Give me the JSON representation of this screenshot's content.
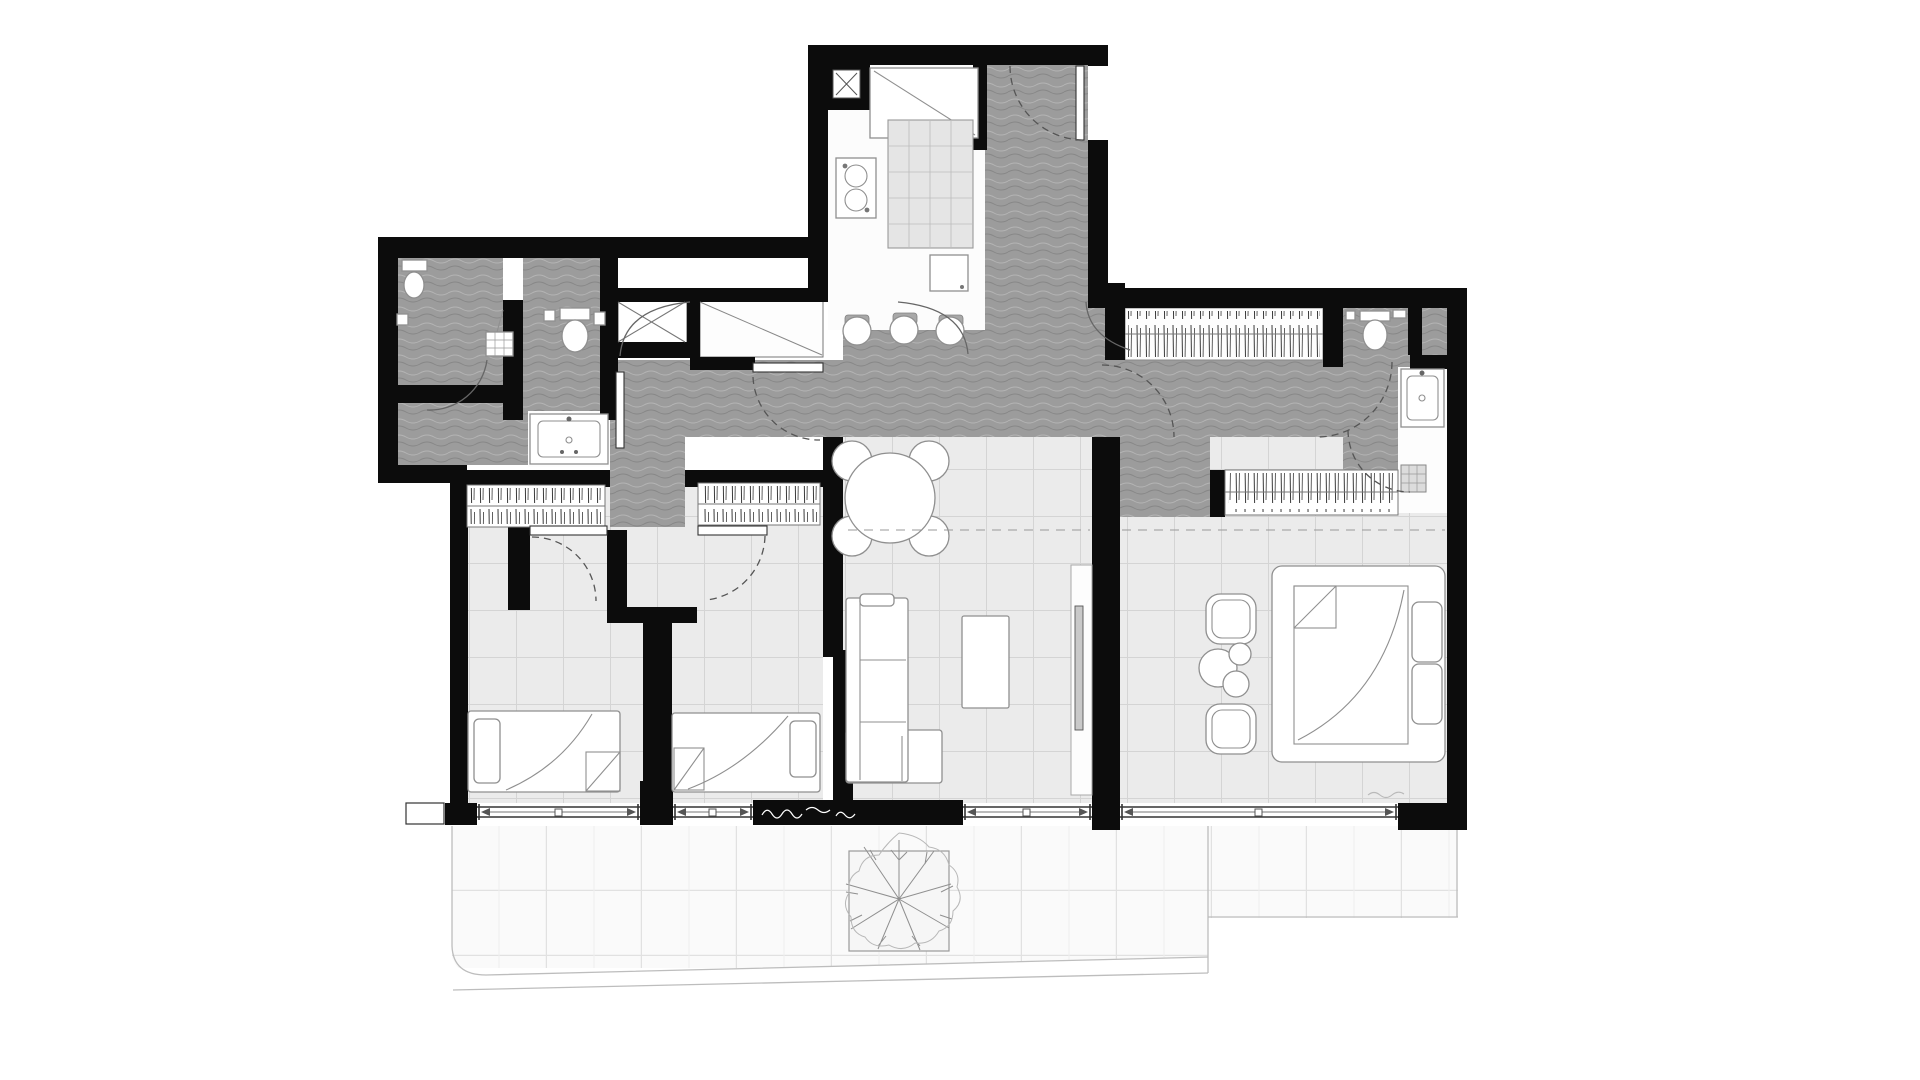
{
  "meta": {
    "content_type": "architectural-floor-plan",
    "visible_text": "none",
    "style": "black walls, textured gray circulation zones, gridded light floors, white furniture symbols"
  },
  "colors": {
    "background": "#ffffff",
    "wall": "#0c0c0c",
    "hall_base": "#9c9c9c",
    "hall_wave_light": "#b4b4b4",
    "hall_wave_dark": "#878787",
    "tile_fill": "#ebebeb",
    "tile_line": "#d4d4d4",
    "paver_fill": "#fafafa",
    "paver_line": "#e1e1e1",
    "white_room": "#fcfcfc",
    "furniture_fill": "#ffffff",
    "furniture_stroke": "#8f8f8f",
    "island_fill": "#e5e5e5",
    "island_line": "#bcbcbc",
    "hatch_stroke": "#3a3a3a",
    "window_line": "#333333",
    "arc_line": "#666666",
    "dashed_line": "#555555",
    "edge_line": "#bdbdbd",
    "tree_stroke": "#8f8f8f",
    "threshold_mark": "#ffffff"
  },
  "semantics": {
    "zones": [
      {
        "id": "kitchen",
        "floor": "white",
        "fixtures": [
          "service-shaft-x",
          "counter-with-diagonal",
          "gridded-island",
          "cooktop-sink-unit",
          "appliance-box",
          "three-bar-stools"
        ]
      },
      {
        "id": "entry-hall",
        "floor": "textured-gray",
        "fixtures": [
          "entry-door-swing"
        ]
      },
      {
        "id": "corridor",
        "floor": "textured-gray",
        "fixtures": [
          "flared-arc-openings",
          "hall-door-leaf",
          "crossed-shaft",
          "coat-closet-diagonal"
        ]
      },
      {
        "id": "bathroom",
        "floor": "textured-gray",
        "fixtures": [
          "toilet",
          "shower-head",
          "wc-toilet",
          "washbasin-vanity",
          "door-leaf",
          "door-swing"
        ]
      },
      {
        "id": "bedroom-1",
        "floor": "tile-grid",
        "fixtures": [
          "wardrobe-hatch",
          "door-swing",
          "single-bed"
        ]
      },
      {
        "id": "bedroom-2",
        "floor": "tile-grid",
        "fixtures": [
          "wardrobe-hatch",
          "door-swing",
          "single-bed"
        ]
      },
      {
        "id": "living-dining",
        "floor": "tile-grid",
        "fixtures": [
          "round-table-four-chairs",
          "l-shaped-sofa",
          "coffee-table",
          "tv-sideboard"
        ]
      },
      {
        "id": "master-suite",
        "floor": "tile-grid",
        "fixtures": [
          "hanger-closet",
          "wardrobe-hatch",
          "wc-toilet",
          "washbasin",
          "shower-drain-grid",
          "double-bed",
          "two-armchairs",
          "side-table-circles",
          "door-swings",
          "dashed-section-line"
        ]
      },
      {
        "id": "terrace",
        "floor": "large-pavers",
        "fixtures": [
          "tree-in-planter",
          "window-bands",
          "black-threshold-with-marks",
          "curved-edge"
        ]
      }
    ]
  }
}
